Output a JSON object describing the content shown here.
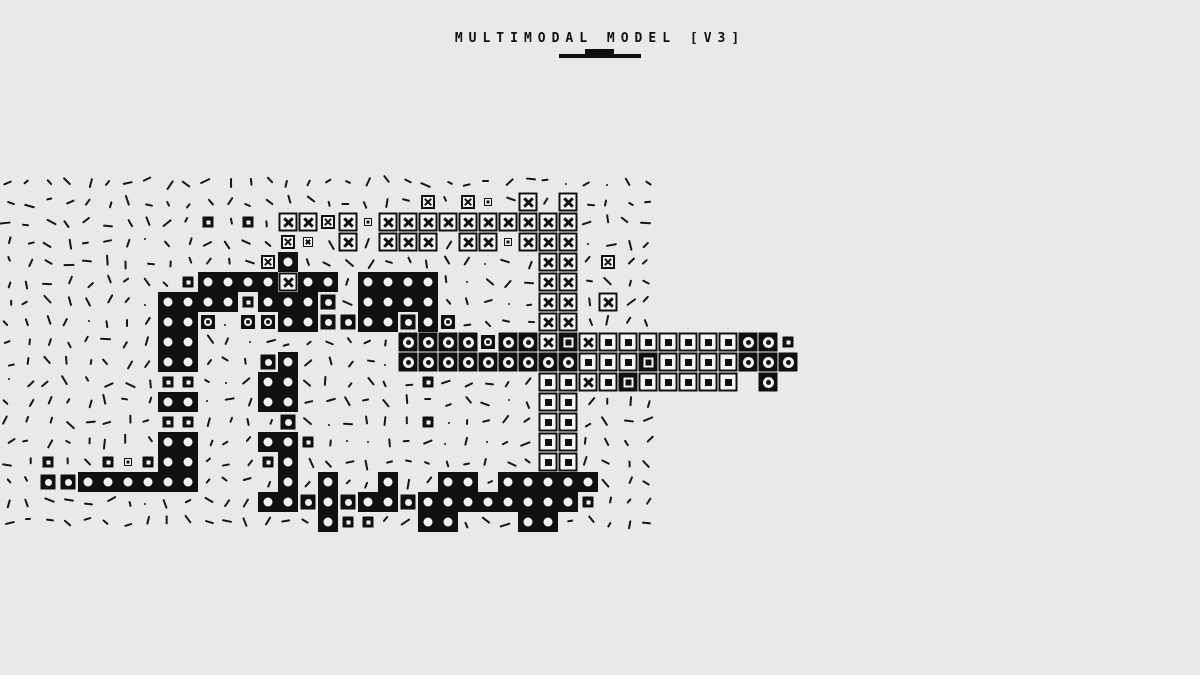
{
  "header": {
    "title": "MULTIMODAL MODEL [V3]"
  },
  "colors": {
    "background": "#e9e9e9",
    "ink": "#101010",
    "tile_fill": "#f6f6f6"
  },
  "legend": {
    "X": "x-mark-tile",
    "Y": "x-mark-tile-small",
    "x": "x-mark-tile-tiny",
    "O": "dot-tile",
    "o": "dot-tile-small",
    "Q": "ring-tile",
    "q": "ring-tile-small",
    "S": "square-tile",
    "Z": "inverse-square-tile",
    "s": "mini-square-tile",
    "t": "micro-square-tile",
    ".": "dash-mark"
  },
  "grid": {
    "cols": 40,
    "rows": 18,
    "pitch": 20,
    "origin_x": 8,
    "origin_y": 182,
    "rows_map": [
      ".................................",
      ".....................Y.Yt.X.X....",
      "..........s.s.XXYXtXXXXXXXXXX....",
      "..............Yx.X.XXX.XXtXXX....",
      ".............YO............XX.Y..",
      ".........sOOOOXOO.OOOO.....XX....",
      "........OOOOsOOOo.OOOO.....XX.X..",
      "........OOq.qqOOooOOoOq....XX....",
      "........OO..........QQQQqQQXZXSSSSSSSQQs",
      "........OO...oO.....QQQQQQQQQSSSZSSSSQQQ",
      "........ss...OO......s.....SSXSZSSSSS Q ",
      "........OO...OO............SS....",
      "........ss....o......s.....SS....",
      "........OO...OOs...........SS....",
      "..s..stsOO...sO............SS....",
      "..ooOOOOOO....O.O..O..OO.OOOOO...",
      ".............OOoOoOOoOOOOOOOOs...",
      "................Oss..OO...OO....."
    ]
  }
}
